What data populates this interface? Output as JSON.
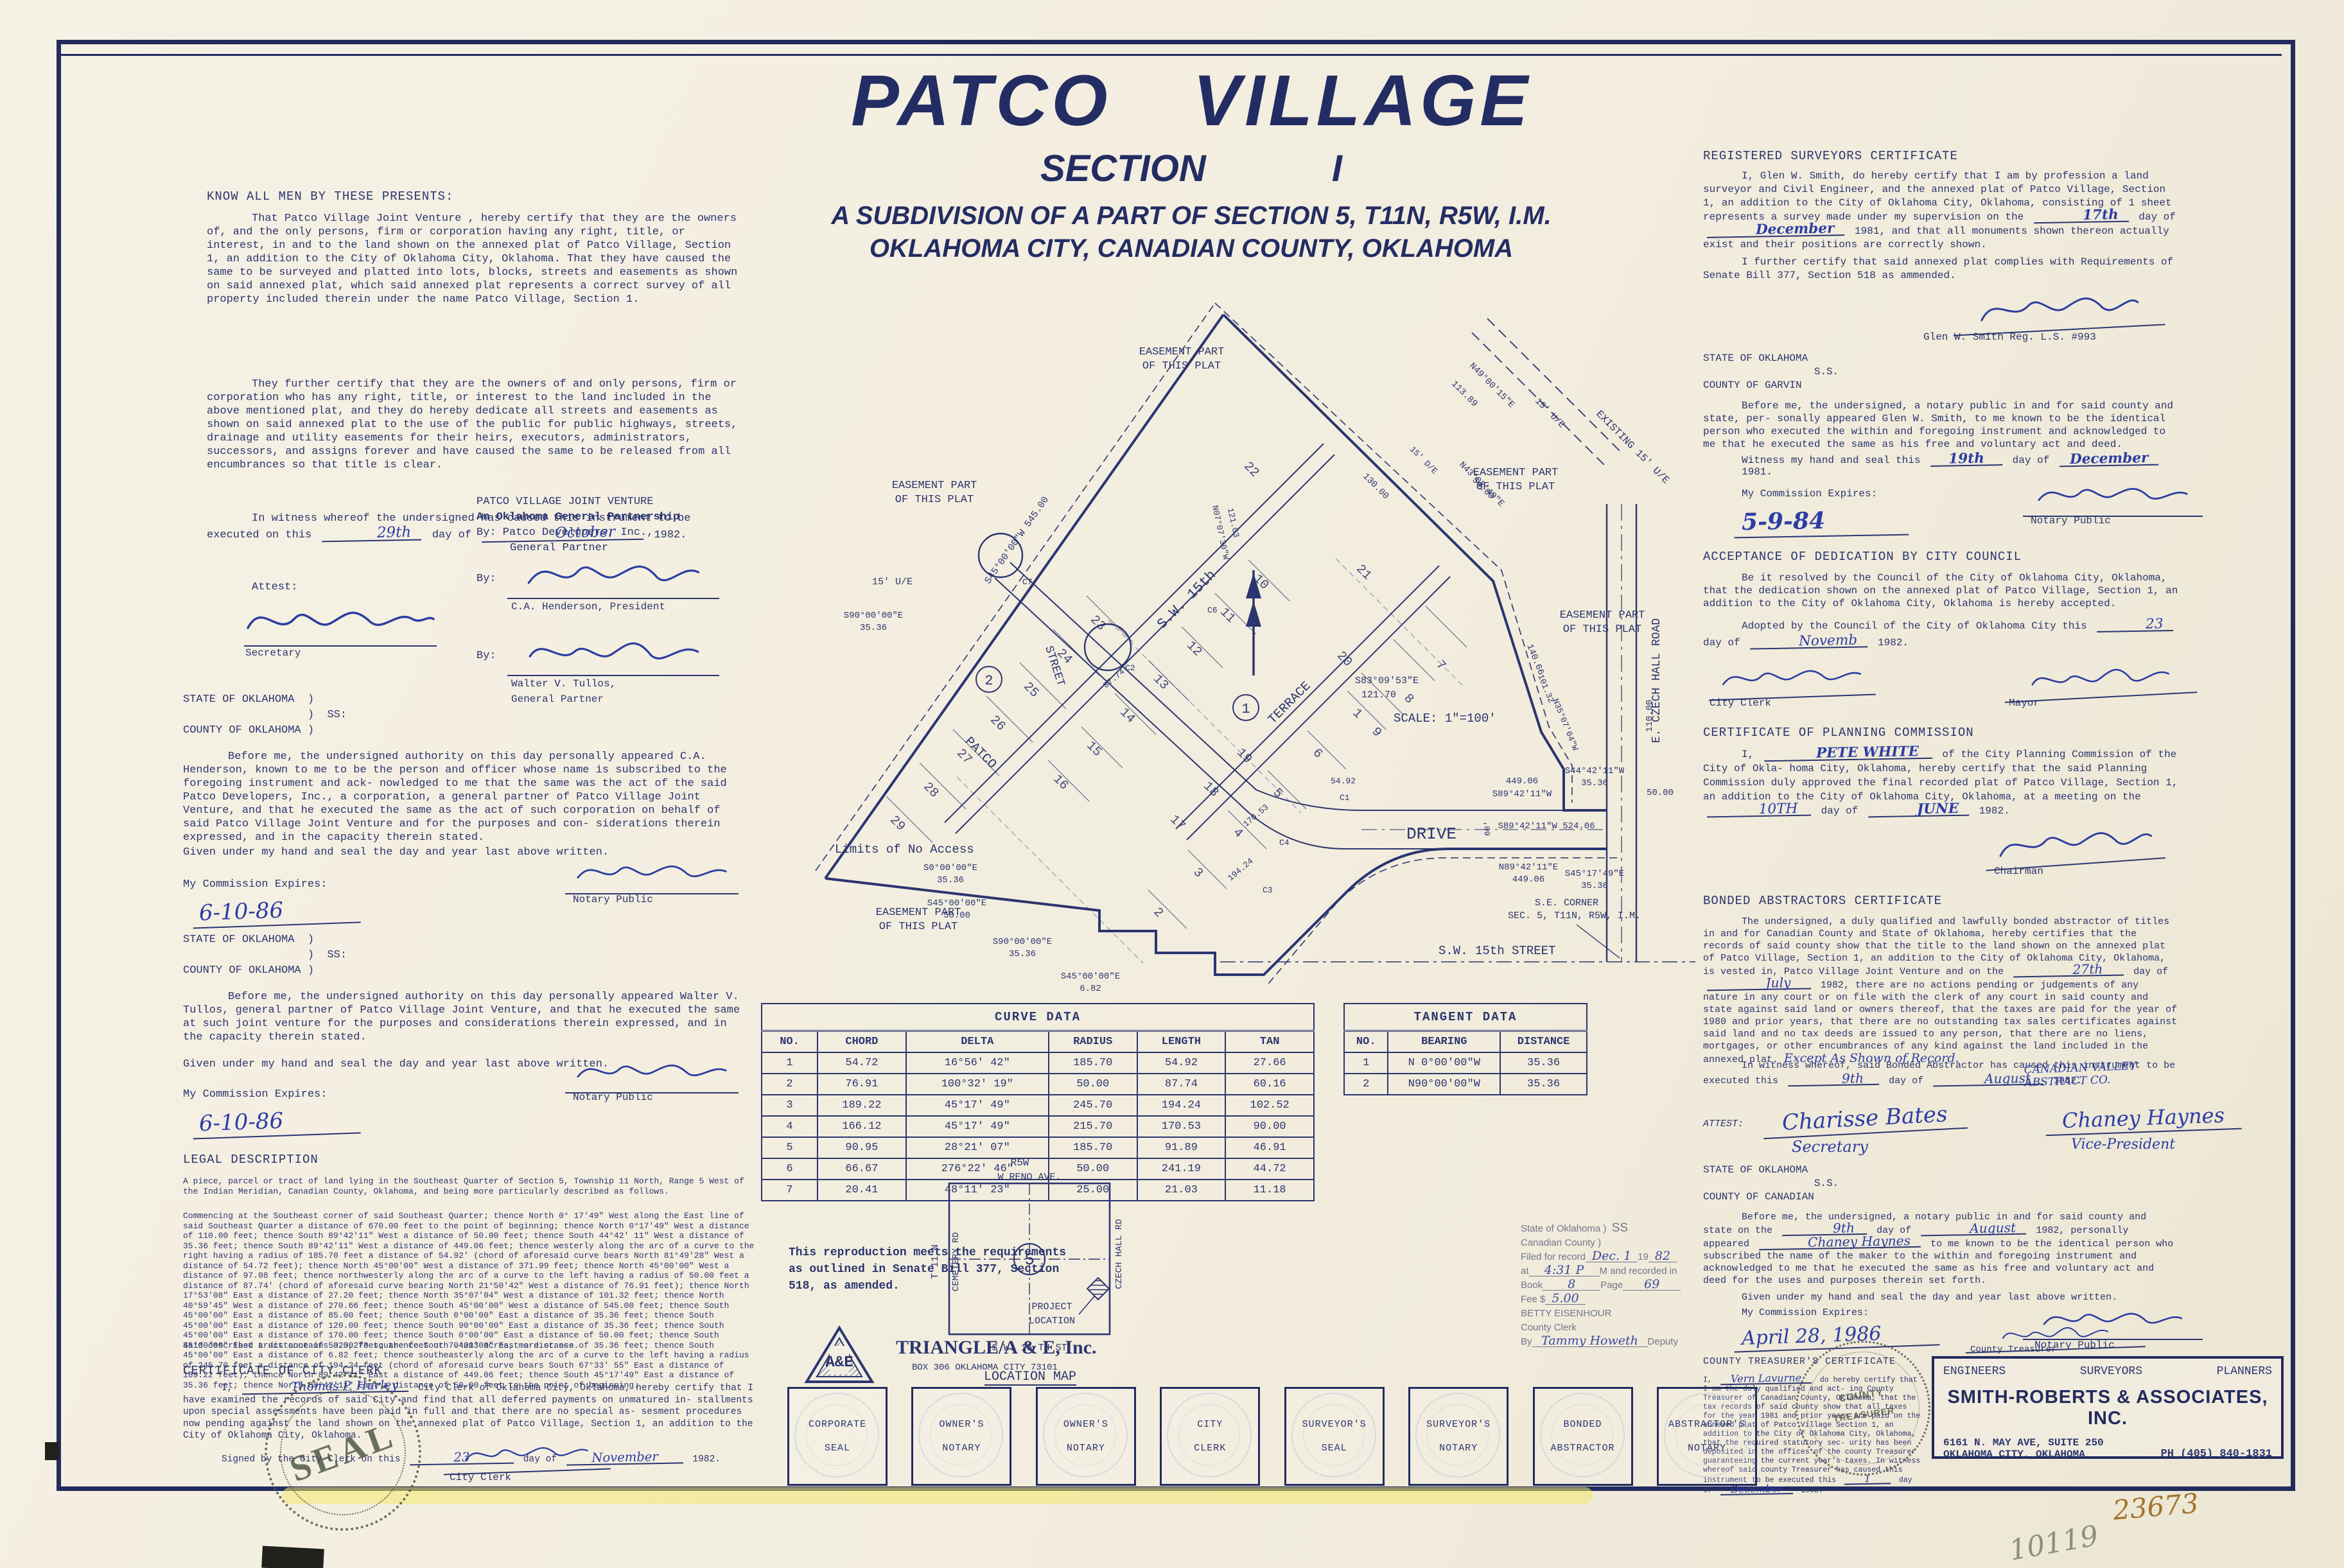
{
  "title": {
    "line1": "PATCO   VILLAGE",
    "line2": "SECTION        I",
    "line3": "A SUBDIVISION OF A PART OF SECTION 5, T11N, R5W, I.M.",
    "line4": "OKLAHOMA CITY, CANADIAN COUNTY, OKLAHOMA"
  },
  "dedication": {
    "heading": "KNOW ALL MEN BY THESE PRESENTS:",
    "p1": "That Patco Village Joint Venture , hereby certify that they are the owners of, and the only persons, firm or corporation having any right, title, or interest, in and to the land shown on the annexed plat of Patco Village, Section 1, an addition to the City of Oklahoma City, Oklahoma.  That they have caused the same to be surveyed and platted into lots, blocks, streets and easements as shown on said annexed plat, which said annexed plat represents a correct survey of all property included therein under the name Patco Village, Section 1.",
    "p2": "They further certify that they are the owners of and only persons, firm or corporation who has any right, title, or interest to the land included in the above mentioned plat, and they do hereby dedicate  all streets and easements as shown on said annexed plat to the use of the public for public highways, streets, drainage and utility easements for their heirs, executors, administrators, successors, and assigns forever and have caused the same to be released from all encumbrances so that title is clear.",
    "wit_a": "In witness whereof the undersigned has caused this instrument to be executed on this",
    "wit_day": "29th",
    "wit_b": "day of",
    "wit_month": "October",
    "wit_c": "1982."
  },
  "owner": {
    "l1": "PATCO VILLAGE JOINT VENTURE",
    "l2": "An Oklahoma General Partnership",
    "l3": "By:  Patco Developers, Inc.,",
    "l4": "General Partner",
    "by": "By:",
    "sig1_label": "C.A. Henderson, President",
    "sig2_label1": "Walter V. Tullos,",
    "sig2_label2": "General Partner",
    "attest": "Attest:",
    "attest_label": "Secretary"
  },
  "state_ok_okc": "STATE OF OKLAHOMA  )\n                   )  SS:\nCOUNTY OF OKLAHOMA )",
  "notary1": {
    "p": "Before me, the undersigned authority on this day personally appeared C.A. Henderson, known to me to be the person and officer whose name is subscribed to the foregoing instrument and ack- nowledged to me that the same was the act of the said Patco Developers, Inc., a corporation, a general partner of Patco Village Joint Venture, and that he executed the same as the act of such corporation on behalf of said Patco Village Joint Venture and for the purposes and con- siderations therein expressed, and in the capacity therein stated.",
    "given": "Given under my hand and seal the day and year last above written.",
    "commission_label": "My Commission Expires:",
    "commission": "6-10-86",
    "notary_label": "Notary Public"
  },
  "notary2": {
    "p": "Before me, the undersigned authority on this day personally appeared Walter V. Tullos, general partner of Patco Village Joint Venture, and that he executed the same at such joint venture for the purposes and considerations therein expressed, and in the capacity therein stated.",
    "given": "Given under my hand and seal the day and year last above written.",
    "commission_label": "My Commission Expires:",
    "commission": "6-10-86",
    "notary_label": "Notary Public"
  },
  "legal": {
    "heading": "LEGAL DESCRIPTION",
    "p1": "A piece, parcel or tract of land lying in the Southeast Quarter of Section 5, Township 11 North, Range 5 West of the Indian Meridian, Canadian County, Oklahoma, and being more particularly described as follows.",
    "p2": "Commencing at the Southeast corner of said Southeast Quarter; thence North 0° 17'49\" West along the East line of said Southeast Quarter a distance of 670.00 feet to the point of beginning; thence North 0°17'49\" West a distance of 110.00 feet; thence South 89°42'11\" West a distance of 50.00 feet; thence South 44°42' 11\" West a distance of 35.36 feet; thence South 89°42'11\" West a distance of 449.06 feet; thence westerly along the arc of a curve to the right having a radius of 185.70 feet a distance of 54.92' (chord of aforesaid curve bears North 81°49'28\" West a distance of 54.72 feet); thence North 45°00'00\" West a distance of 371.99 feet; thence North 45°00'00\" West a distance of 97.08 feet; thence northwesterly along the arc of a curve to the left having a radius of 50.00 feet a distance of 87.74' (chord of aforesaid curve bearing North 21°50'42\" West a distance of 76.91 feet); thence North 17°53'08\" East a distance of 27.20 feet; thence North 35°07'04\" West a distance of 101.32 feet; thence North 40°59'45\" West a distance of 270.66 feet; thence South 45°00'00\" West a distance of 545.00 feet; thence South 45°00'00\" East a distance of 85.00 feet; thence South 0°00'00\" East a distance of 35.36 feet; thence South 45°00'00\" East a distance of 120.00 feet; thence South 90°00'00\" East a distance of 35.36 feet; thence South 45°00'00\" East a distance of 170.00 feet; thence South 0°00'00\" East a distance of 50.00 feet; thence South 45°00'00\" East a distance of 50.00 feet; thence South 0°00'00\" East a distance of 35.36 feet; thence South 45°00'00\" East a distance of 6.82 feet; thence southeasterly along the arc of a curve to the left having a radius of 245.70 feet a distance of 194.24 feet (chord of aforesaid curve bears South 67°33' 55\" East a distance of 189.22 feet); thence North 89°42'11\" East a distance of 449.06 feet; thence South 45°17'49\" East a distance of 35.36 feet; thence North 89°42'11\" East a distance of 50.00 feet to the point of beginning.",
    "p3": "Said described tract contains 323,273 square feet or 7.4213 acres, more or ess."
  },
  "city_clerk": {
    "heading": "CERTIFICATE OF CITY CLERK",
    "a": "I,",
    "name": "Thomas P. Hurley",
    "b": "City Clerk of Oklahoma City, Oklahoma, hereby certify that I have examined the records of said City and find that all deferred payments on unmatured in- stallments upon special assessments have been paid in full and that there are no special as- sesment procedures now pending against the land shown on the annexed plat of Patco Village, Section 1, an addition to the City of Oklahoma City, Oklahoma.",
    "signed_a": "Signed by the City Clerk on this",
    "signed_day": "23",
    "signed_b": "day of",
    "signed_month": "November",
    "signed_c": "1982.",
    "sig_label": "City Clerk"
  },
  "surveyor": {
    "heading": "REGISTERED SURVEYORS CERTIFICATE",
    "p1a": "I, Glen W. Smith, do hereby certify that I am by profession a land surveyor and Civil Engineer, and the annexed plat of Patco Village, Section 1, an addition to the City of Oklahoma City, Oklahoma, consisting of 1 sheet represents a survey made under my supervision on the",
    "day": "17th",
    "of": "day of",
    "month": "December",
    "p1b": "1981, and that all monuments shown thereon actually exist and their positions are correctly shown.",
    "p2": "I further certify that said annexed plat complies with Requirements of Senate Bill 377, Section 518 as ammended.",
    "sig_label": "Glen W. Smith    Reg. L.S.  #993"
  },
  "garvin": {
    "state": "STATE OF OKLAHOMA\n                  S.S.\nCOUNTY OF GARVIN",
    "p": "Before me, the undersigned, a notary public in and for said county and state, per- sonally appeared Glen W. Smith, to me known to be the identical person who executed the within and foregoing instrument and acknowledged to me that he executed the same as his free and voluntary act and deed.",
    "wit_a": "Witness my hand and seal this",
    "wit_day": "19th",
    "wit_b": "day of",
    "wit_month": "December",
    "wit_c": "1981.",
    "commission_label": "My Commission Expires:",
    "commission": "5-9-84",
    "notary_label": "Notary Public"
  },
  "acceptance": {
    "heading": "ACCEPTANCE OF DEDICATION BY CITY COUNCIL",
    "p": "Be it resolved by the Council of the City of Oklahoma City, Oklahoma, that the dedication shown on the annexed plat of Patco Village, Section 1, an addition to the City of Oklahoma City, Oklahoma is hereby accepted.",
    "ad_a": "Adopted by the Council of the City of Oklahoma City this",
    "ad_day": "23",
    "ad_b": "day of",
    "ad_month": "Novemb",
    "ad_c": "1982.",
    "clerk_label": "City Clerk",
    "mayor_label": "Mayor"
  },
  "planning": {
    "heading": "CERTIFICATE OF PLANNING COMMISSION",
    "a": "I,",
    "name": "PETE WHITE",
    "b": "of the City Planning Commission of the City of Okla- homa City, Oklahoma, hereby certify that the said Planning Commission duly approved the final recorded plat of Patco Village, Section 1, an addition to the City of Oklahoma City, Oklahoma, at a meeting on the",
    "day": "10TH",
    "c": "day of",
    "month": "JUNE",
    "d": "1982.",
    "sig_label": "Chairman"
  },
  "abstractor": {
    "heading": "BONDED ABSTRACTORS CERTIFICATE",
    "p1a": "The undersigned, a duly qualified and lawfully bonded abstractor of titles in and for Canadian County and State of Oklahoma, hereby certifies that the records of said county show that the title to the land shown on the annexed plat of Patco Village, Section 1, an addition to the City of Oklahoma City, Oklahoma, is vested in, Patco Village Joint Venture and on the",
    "day": "27th",
    "of": "day of",
    "month": "July",
    "p1b": "1982, there are no actions pending or judgements of any nature in any court or on file with the clerk of any court in said county and state against said land or owners thereof, that the taxes are paid for the year of 1980 and prior years, that there are no outstanding tax sales certificates against said land and no tax deeds are issued to any person, that there are no liens, mortgages, or other encumbrances of any kind against the land included in the annexed plat.",
    "hw_tail": "Except As Shown of Record.",
    "p2a": "In witness whereof, said Bonded Abstractor has caused this instrument to be executed this",
    "wit_day": "9th",
    "p2b": "day of",
    "wit_month": "August",
    "p2c": "1982.",
    "company": "CANADIAN VALLEY ABSTRACT CO.",
    "attest": "ATTEST:",
    "attest_name": "Charisse Bates",
    "attest_label": "Secretary",
    "vp_name": "Chaney Haynes",
    "vp_label": "Vice-President"
  },
  "canadian": {
    "state": "STATE OF OKLAHOMA\n                  S.S.\nCOUNTY OF CANADIAN",
    "pa": "Before me, the undersigned, a notary public in and for said county and state on the",
    "day": "9th",
    "pb": "day of",
    "month": "August",
    "pc": "1982, personally appeared",
    "name": "Chaney Haynes",
    "pd": "to me known to be the identical person who subscribed the name of the maker to the within and foregoing instrument and acknowledged to me that he executed the same as his free and voluntary act and deed for the uses and purposes therein set forth.",
    "given": "Given under my hand and seal the day and year last above written.",
    "commission_label": "My Commission Expires:",
    "commission": "April 28, 1986",
    "notary_label": "Notary Public"
  },
  "treasurer": {
    "heading": "COUNTY TREASURER'S CERTIFICATE",
    "a": "I,",
    "name": "Vern Lavurne",
    "b": "do hereby certify that I am the duly qualified and act- ing County Treasurer of Canadian County, Oklahoma, that the tax records of said county show that all taxes for the year 1981 and prior years are paid on the annexed plat of Patco Village Section 1, an addition to the City of Oklahoma City, Oklahoma, that the required statutory sec- urity has been deposited in the offices of the county Treasurer guaranteeing the current year's taxes.",
    "wit_a": "In witness whereof said county Treasurer has caused this instrument to be executed this",
    "wit_day": "1",
    "wit_b": "day of",
    "wit_month": "December",
    "wit_c": "1982.",
    "sig_label": "County Treasurer"
  },
  "filing": {
    "l1": "State of Oklahoma  )",
    "ss": "SS",
    "l2": "Canadian County    )",
    "l3a": "Filed for record",
    "l3hw": "Dec. 1",
    "l3b": "19",
    "l3hw2": "82",
    "l4a": "at",
    "l4hw": "4:31 P",
    "l4b": "M and recorded in",
    "l5a": "Book",
    "l5hw": "8",
    "l5b": "Page",
    "l5hw2": "69",
    "l6a": "Fee $",
    "l6hw": "5.00",
    "l7": "BETTY EISENHOUR",
    "l8": "County Clerk",
    "l9a": "By",
    "l9hw": "Tammy Howeth",
    "l9b": "Deputy"
  },
  "curve_table": {
    "title": "CURVE  DATA",
    "headers": [
      "NO.",
      "CHORD",
      "DELTA",
      "RADIUS",
      "LENGTH",
      "TAN"
    ],
    "rows": [
      [
        "1",
        "54.72",
        "16°56' 42\"",
        "185.70",
        "54.92",
        "27.66"
      ],
      [
        "2",
        "76.91",
        "100°32' 19\"",
        "50.00",
        "87.74",
        "60.16"
      ],
      [
        "3",
        "189.22",
        "45°17' 49\"",
        "245.70",
        "194.24",
        "102.52"
      ],
      [
        "4",
        "166.12",
        "45°17' 49\"",
        "215.70",
        "170.53",
        "90.00"
      ],
      [
        "5",
        "90.95",
        "28°21' 07\"",
        "185.70",
        "91.89",
        "46.91"
      ],
      [
        "6",
        "66.67",
        "276°22' 46\"",
        "50.00",
        "241.19",
        "44.72"
      ],
      [
        "7",
        "20.41",
        "48°11' 23\"",
        "25.00",
        "21.03",
        "11.18"
      ]
    ]
  },
  "tangent_table": {
    "title": "TANGENT   DATA",
    "headers": [
      "NO.",
      "BEARING",
      "DISTANCE"
    ],
    "rows": [
      [
        "1",
        "N 0°00'00\"W",
        "35.36"
      ],
      [
        "2",
        "N90°00'00\"W",
        "35.36"
      ]
    ]
  },
  "repro": {
    "text": "This reproduction meets the requirements\nas outlined in Senate Bill 377, Section\n518, as amended.",
    "logo_letters": "A&E",
    "firm": "TRIANGLE/A & E, Inc.",
    "addr": "BOX 306   OKLAHOMA CITY 73101"
  },
  "location_map": {
    "r5w": "R5W",
    "reno": "W   RENO   AVE.",
    "t11n": "T 11 N",
    "cemetery": "CEMETERY   RD",
    "czech": "CZECH   HALL   RD",
    "sw15": "S.W.   15 TH   ST",
    "section": "5",
    "proj1": "PROJECT",
    "proj2": "LOCATION",
    "title": "LOCATION    MAP"
  },
  "map": {
    "labels": {
      "ease_l1": "EASEMENT  PART",
      "ease_l2": "OF  THIS  PLAT",
      "existing_ue": "EXISTING  15'  U/E",
      "ue15": "15' U/E",
      "de15": "15' D/E",
      "limits": "Limits  of  No  Access",
      "street_sw15": "S.W.  15th",
      "street_word": "STREET",
      "terrace": "TERRACE",
      "patco": "PATCO",
      "drive": "DRIVE",
      "czech": "E.  CZECH  HALL  ROAD",
      "scale": "SCALE: 1\"=100'",
      "b449": "449.06",
      "s8942": "S89°42'11\"W",
      "b524": "S89°42'11\"W   524.06",
      "n8942": "N89°42'11\"E",
      "s4442": "S44°42'11\"W",
      "v3536": "35.36",
      "s4517": "S45°17'49\"E",
      "s90": "S90°00'00\"E",
      "s0": "S0°00'00\"E",
      "s45": "S45°00'00\"E",
      "v50": "50.00",
      "v682": "6.82",
      "b545": "S45°00'00\"W   545.00",
      "n3507": "N35°07'04\"W",
      "v10132": "101.32",
      "v14066": "140.66",
      "v13000": "130.00",
      "n4900": "N49°00'15\"E",
      "v11389": "113.89",
      "n4302": "N43°02'49\"E",
      "v5400": "54.00",
      "s8309": "S83°09'53\"E",
      "v12170": "121.70",
      "n0707": "N07°07'30\"W",
      "v12103": "121.03",
      "c1": "C1",
      "c2": "C2",
      "c3": "C3",
      "c4": "C4",
      "c6": "C6",
      "c7": "C7",
      "v5492": "54.92",
      "v17053": "170.53",
      "v19424": "194.24",
      "v8774": "87.74",
      "v110": "110.00",
      "v60": "60'",
      "se1": "S.E. CORNER",
      "se2": "SEC. 5, T11N, R5W, I.M.",
      "sw15st": "S.W.  15th  STREET"
    },
    "lots": [
      "1",
      "2",
      "3",
      "4",
      "5",
      "6",
      "7",
      "8",
      "9",
      "10",
      "11",
      "12",
      "13",
      "14",
      "15",
      "16",
      "17",
      "18",
      "19",
      "20",
      "21",
      "22",
      "23",
      "24",
      "25",
      "26",
      "27",
      "28",
      "29"
    ],
    "block1": "1",
    "block2": "2"
  },
  "seals": {
    "boxes": [
      [
        "CORPORATE",
        "SEAL"
      ],
      [
        "OWNER'S",
        "NOTARY"
      ],
      [
        "OWNER'S",
        "NOTARY"
      ],
      [
        "CITY",
        "CLERK"
      ],
      [
        "SURVEYOR'S",
        "SEAL"
      ],
      [
        "SURVEYOR'S",
        "NOTARY"
      ],
      [
        "BONDED",
        "ABSTRACTOR"
      ],
      [
        "ABSTRACTOR'S",
        "NOTARY"
      ]
    ],
    "round_seal": "SEAL",
    "treasurer_l1": "COUNTY",
    "treasurer_l2": "TREASURER"
  },
  "firm": {
    "c1": "ENGINEERS",
    "c2": "SURVEYORS",
    "c3": "PLANNERS",
    "name": "SMITH-ROBERTS  &  ASSOCIATES, INC.",
    "addr1": "6161 N. MAY AVE, SUITE 250",
    "addr2": "OKLAHOMA CITY, OKLAHOMA",
    "phone": "PH (405)  840-1831"
  },
  "annotations": {
    "sheet_no": "23673",
    "pencil_no": "10119"
  }
}
